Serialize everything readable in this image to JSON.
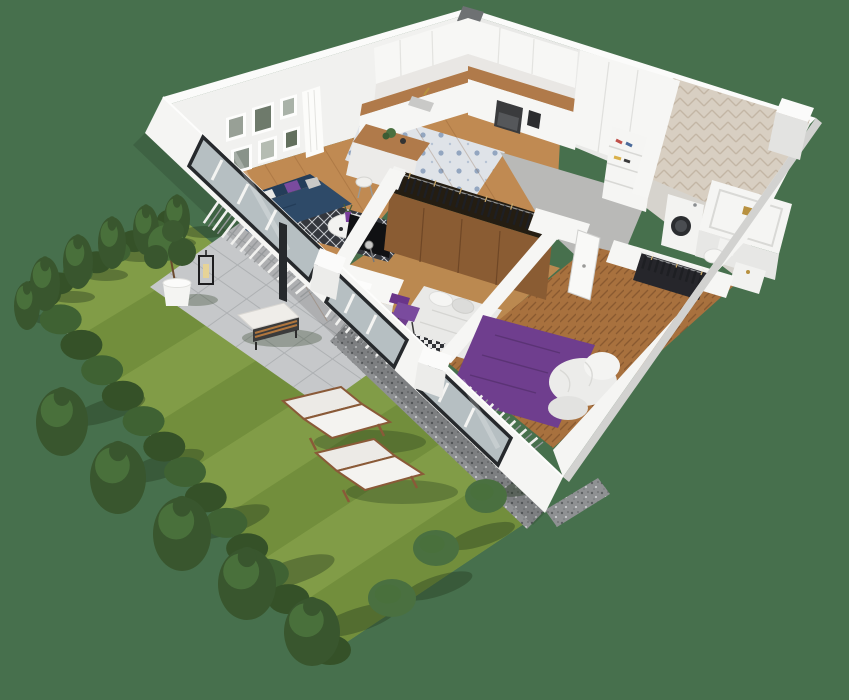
{
  "scene": {
    "title": "3D apartment floor plan with private garden",
    "view": "isometric cutaway render",
    "rooms": [
      {
        "name": "Living room",
        "floor": "wood planks",
        "items": [
          "navy corner sofa",
          "white pillow",
          "purple pillow",
          "diamond pattern rug",
          "round white coffee table",
          "purple vase",
          "TV panel",
          "gallery picture wall",
          "white curtain"
        ]
      },
      {
        "name": "Kitchen",
        "floor": "patterned blue-white tile",
        "items": [
          "white upper cabinets",
          "white base cabinets",
          "wood countertop",
          "sink with gold faucet",
          "oven and cooktop",
          "coffee machine",
          "kitchen island with wood top",
          "two stools",
          "tall white cabinet"
        ]
      },
      {
        "name": "Small bedroom",
        "floor": "wood planks",
        "items": [
          "white desk",
          "desk lamp",
          "purple chair",
          "bed with white duvet",
          "checkered blanket",
          "purple throw",
          "TV panel"
        ]
      },
      {
        "name": "Main bedroom",
        "floor": "herringbone parquet",
        "items": [
          "double bed with purple duvet",
          "white bedding",
          "open white door",
          "open wardrobe with hanging clothes"
        ]
      },
      {
        "name": "Hallway",
        "floor": "gray concrete",
        "items": [
          "long open wardrobe with hanging clothes",
          "white bookshelf"
        ]
      },
      {
        "name": "Bathroom",
        "wall": "beige herringbone tile",
        "items": [
          "washing machine",
          "bathtub with gold rail",
          "toilet",
          "vanity cabinet"
        ]
      }
    ],
    "facade": {
      "window_count": 3,
      "glazing": "floor-to-ceiling dark frames",
      "blinds": "white vertical slats"
    },
    "garden": {
      "lawn": "striped mown grass",
      "items": [
        "conifer hedge",
        "six slim conifers",
        "five large conifers",
        "three round bushes",
        "paver patio",
        "gravel strips",
        "two white sun loungers",
        "bench with white cushion",
        "potted tree in white planter",
        "black candle lantern"
      ]
    }
  },
  "palette": {
    "background": "#47704d",
    "lawn": "#819c47",
    "lawn_stripe": "#728e3c",
    "hedge": "#3f6233",
    "hedge_dark": "#355128",
    "tree_dark": "#39562e",
    "tree_mid": "#49703b",
    "bush": "#4a7040",
    "shadow": "rgba(35,55,28,0.38)",
    "patio": "#c6c8ca",
    "patio_line": "#aeb1b3",
    "gravel": "#8f9193",
    "curb": "#e9e9e3",
    "wall": "#f5f5f3",
    "wall_top": "#fbfbfa",
    "wall_face": "#efefed",
    "wall_shade": "#d2d2d0",
    "window_frame": "#26292c",
    "glass": "#b6bfc2",
    "blind_light": "#f0f0ee",
    "blind_dark": "#96999b",
    "wood_floor": "#c08a52",
    "wood_floor2": "#bb8950",
    "herringbone": "#a8713e",
    "wood_counter": "#b07a4a",
    "kitchen_tile": "#dfe3e8",
    "kitchen_tile_motif": "#93a6c0",
    "bath_tile": "#d8cfc2",
    "bath_tile_line": "#c3b6a5",
    "concrete": "#b9b9b7",
    "sofa": "#2e4a68",
    "sofa_dark": "#243d59",
    "pillow_purple": "#7a4b9e",
    "rug": "#34373d",
    "rug_motif": "#c6c9cd",
    "bed_purple": "#6f3e8e",
    "bed_purple_line": "#5b3375",
    "bedding_white": "#ececea",
    "clothes": "#1e1f23",
    "hanger": "#caa96b",
    "wardrobe_wood": "#8a5c33",
    "tv": "#101113",
    "lounger_fabric": "#eceae6",
    "lounger_frame": "#8a5a38",
    "gold": "#b8913f"
  }
}
